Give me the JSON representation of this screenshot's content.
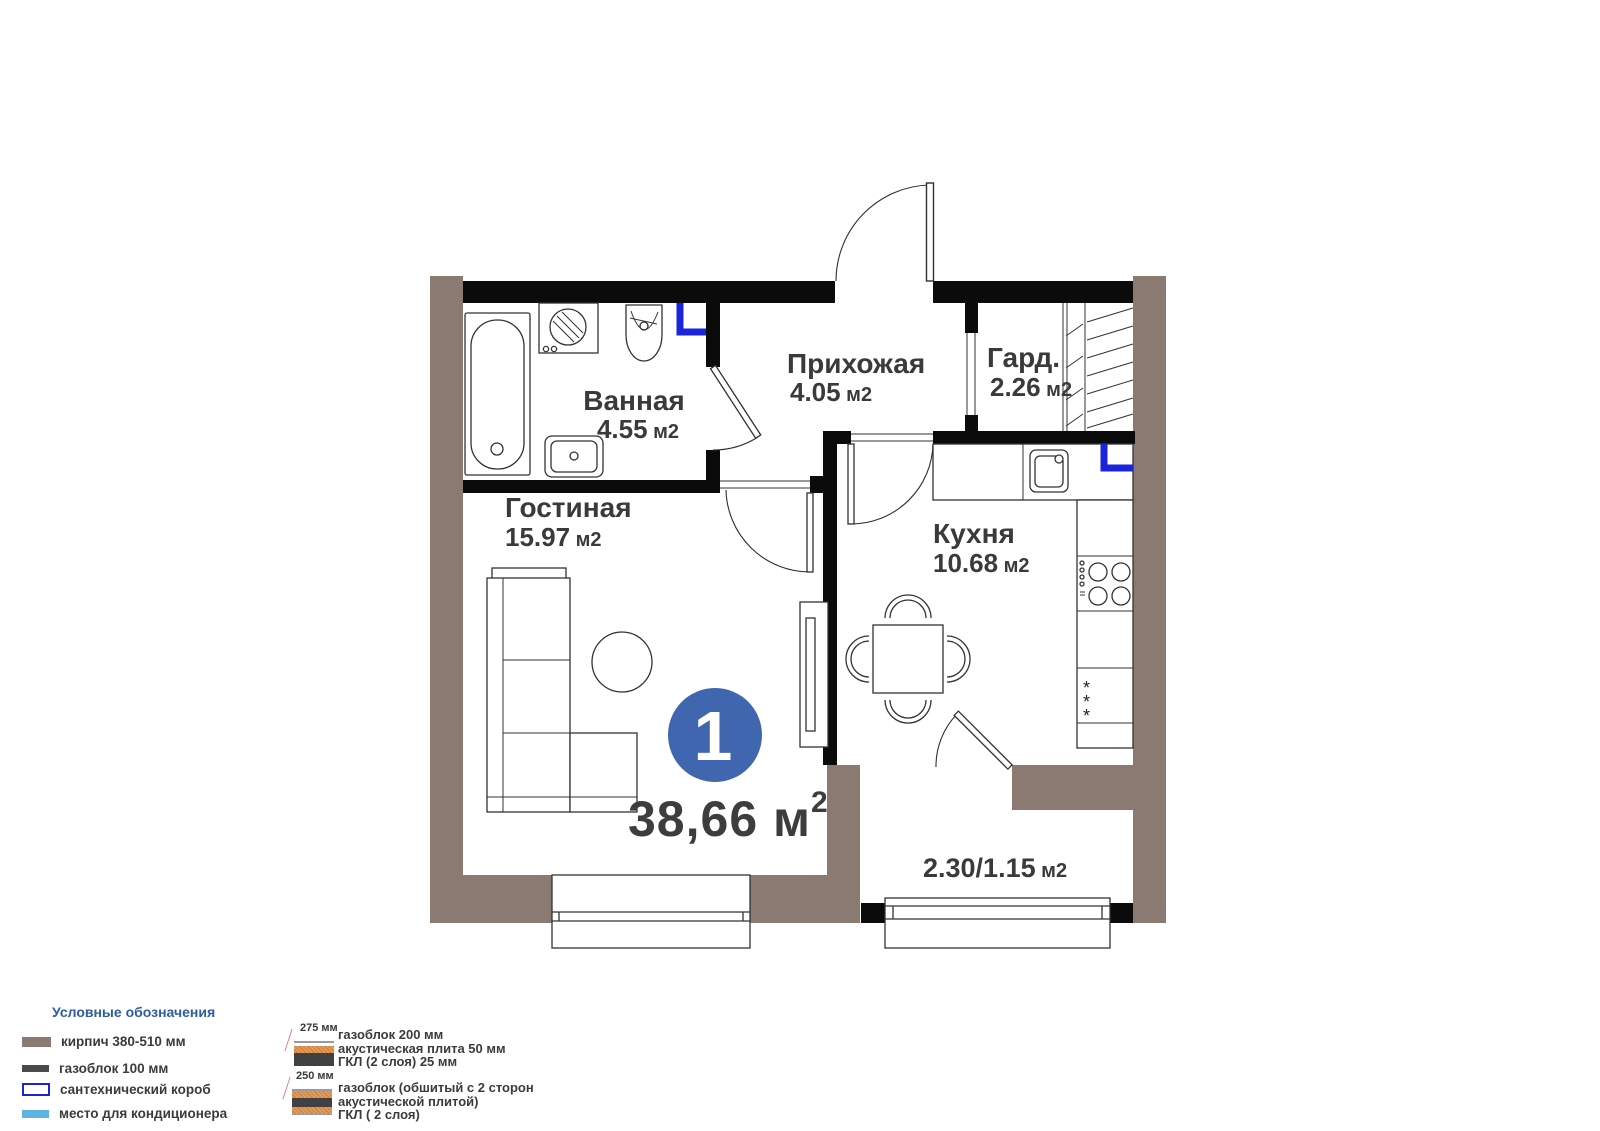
{
  "floor_plan": {
    "unit_badge": "1",
    "total_area": {
      "value": "38,66",
      "unit": " м",
      "sup": "2"
    },
    "rooms": {
      "bathroom": {
        "name": "Ванная",
        "area": "4.55",
        "unit": " м2"
      },
      "hallway": {
        "name": "Прихожая",
        "area": "4.05",
        "unit": " м2"
      },
      "wardrobe": {
        "name": "Гард.",
        "area": "2.26",
        "unit": " м2"
      },
      "living": {
        "name": "Гостиная",
        "area": "15.97",
        "unit": " м2"
      },
      "kitchen": {
        "name": "Кухня",
        "area": "10.68",
        "unit": " м2"
      },
      "balcony": {
        "area": "2.30/1.15",
        "unit": " м2"
      }
    }
  },
  "legend": {
    "title": "Условные обозначения",
    "items": [
      {
        "id": "brick",
        "label": "кирпич 380-510 мм",
        "color": "#8a7a72"
      },
      {
        "id": "gasblock",
        "label": "газоблок 100 мм",
        "color": "#4a4a4a"
      },
      {
        "id": "plumbing-box",
        "label": "сантехнический короб",
        "color": "#1b24d8"
      },
      {
        "id": "ac-place",
        "label": "место для кондиционера",
        "color": "#5fb3e0"
      }
    ]
  },
  "wall_sections": [
    {
      "dimension": "275 мм",
      "lines": [
        "газоблок 200 мм",
        "акустическая плита 50 мм",
        "ГКЛ (2 слоя) 25 мм"
      ]
    },
    {
      "dimension": "250 мм",
      "lines": [
        "газоблок (обшитый с 2 сторон",
        "акустической плитой)",
        "ГКЛ ( 2 слоя)"
      ]
    }
  ],
  "colors": {
    "badge_blue": "#3f66ae",
    "wall_brick": "#8a7a72",
    "wall_black": "#0b0b0b",
    "plumbing_blue": "#1b24d8",
    "ac_blue": "#5fb3e0",
    "legend_title_blue": "#2d5d9f",
    "acoustic_orange": "#dd9050",
    "text_dark": "#3a3a3a"
  }
}
